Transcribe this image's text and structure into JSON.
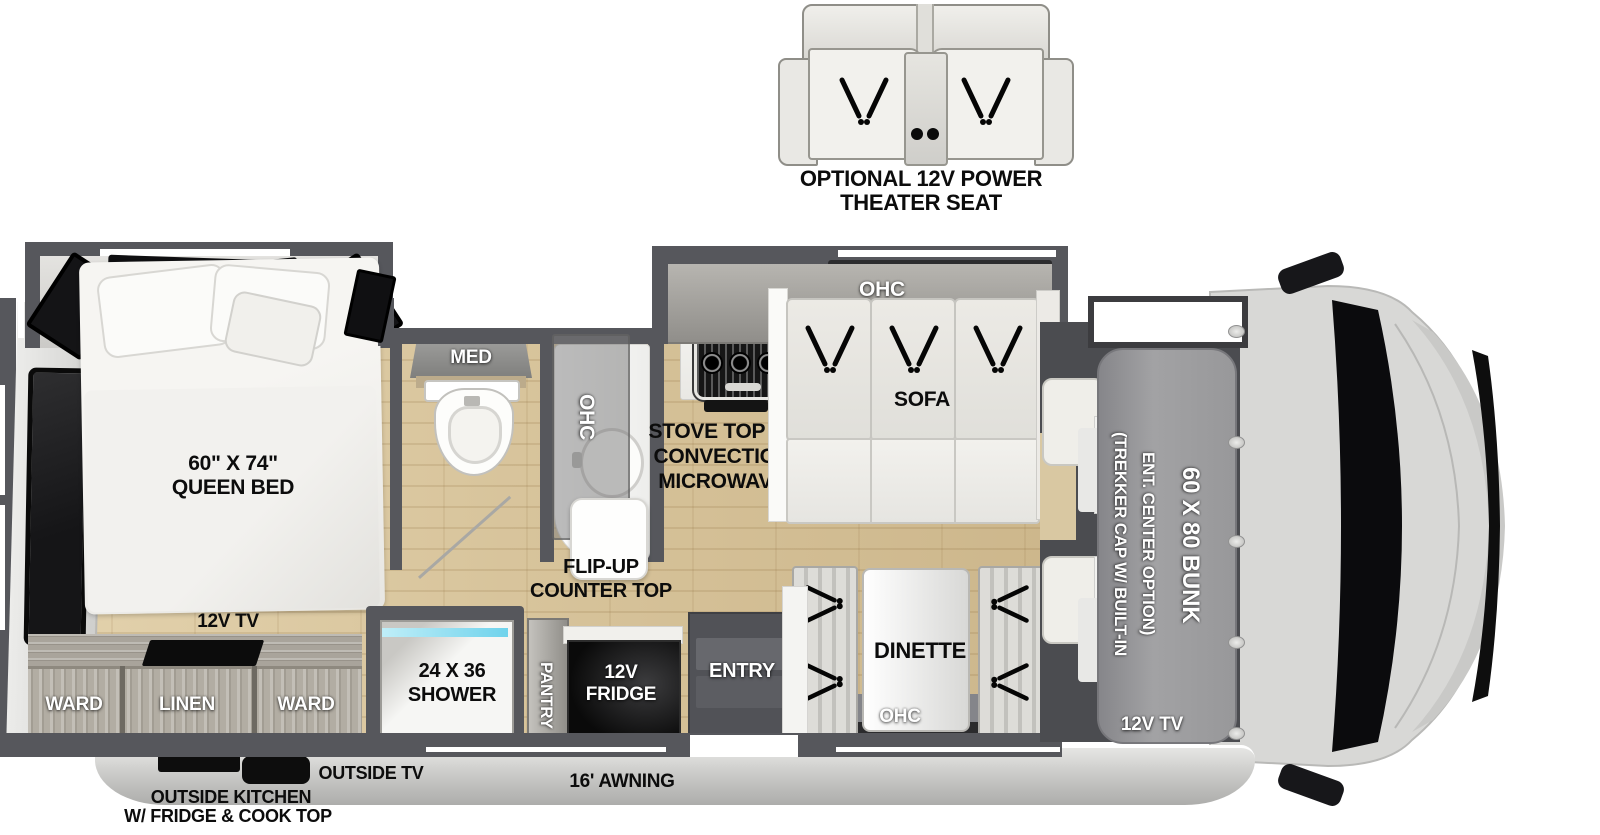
{
  "title": "Class C Motorhome Floor Plan",
  "optional_seat": {
    "label_line1": "OPTIONAL 12V POWER",
    "label_line2": "THEATER SEAT"
  },
  "bedroom": {
    "bed_line1": "60\" X 74\"",
    "bed_line2": "QUEEN BED",
    "tv": "12V TV",
    "ward_left": "WARD",
    "linen": "LINEN",
    "ward_right": "WARD"
  },
  "bathroom": {
    "med": "MED",
    "ohc": "OHC",
    "shower_line1": "24 X 36",
    "shower_line2": "SHOWER"
  },
  "kitchen": {
    "stove_line1": "STOVE TOP W/",
    "stove_line2": "CONVECTION",
    "stove_line3": "MICROWAVE",
    "flip_line1": "FLIP-UP",
    "flip_line2": "COUNTER TOP",
    "pantry": "PANTRY",
    "fridge_line1": "12V",
    "fridge_line2": "FRIDGE"
  },
  "living": {
    "sofa": "SOFA",
    "sofa_ohc": "OHC",
    "dinette": "DINETTE",
    "dinette_ohc": "OHC",
    "entry": "ENTRY"
  },
  "front": {
    "cap_line1": "(TREKKER CAP W/ BUILT-IN",
    "cap_line2": "ENT. CENTER OPTION)",
    "bunk": "60 X 80 BUNK",
    "tv": "12V TV"
  },
  "exterior": {
    "outside_tv": "OUTSIDE TV",
    "outside_kitchen_line1": "OUTSIDE KITCHEN",
    "outside_kitchen_line2": "W/ FRIDGE & COOK TOP",
    "awning": "16' AWNING"
  },
  "colors": {
    "wall": "#56575c",
    "floor_wood": "#dcc8a0",
    "cabinet_wood": "#aaa69c",
    "shower_glass": "#6fd3ec",
    "appliance_black": "#0d0d0d",
    "bunk_gray": "#9a9a9c",
    "cab_body": "#d8d8d6"
  }
}
